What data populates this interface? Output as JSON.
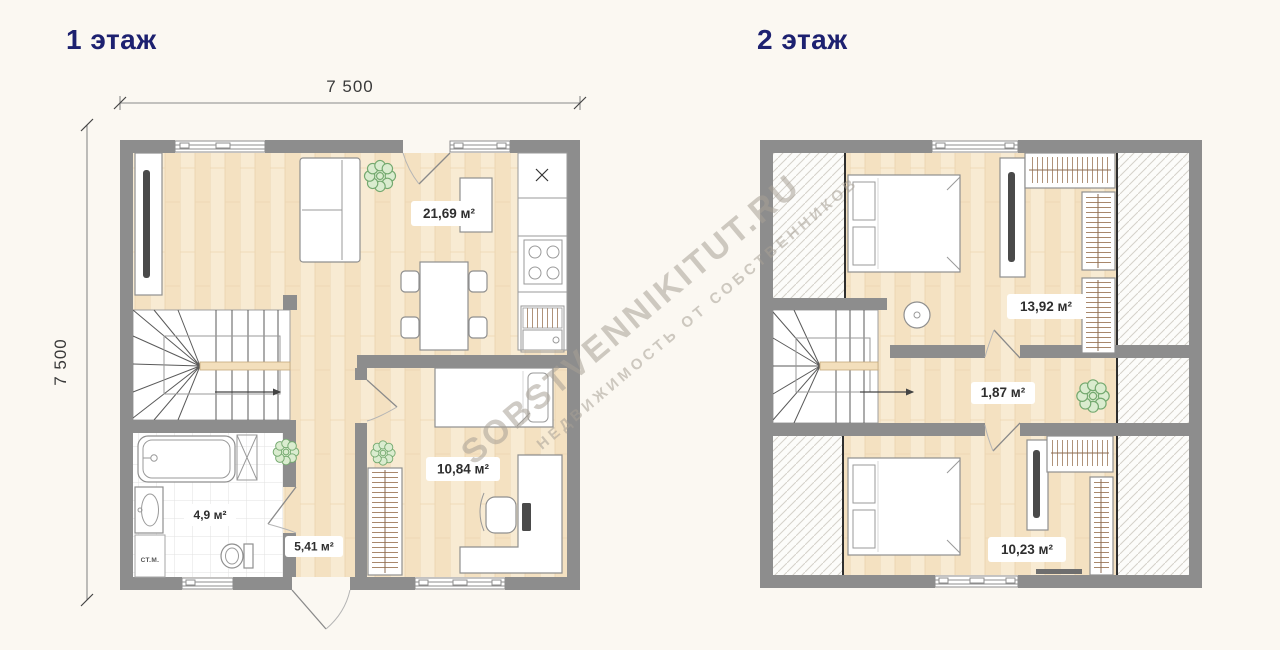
{
  "page": {
    "background": "#fbf8f2"
  },
  "watermark": {
    "line1": "SOBSTVENNIKITUT.RU",
    "line2": "НЕДВИЖИМОСТЬ ОТ СОБСТВЕННИКОВ"
  },
  "floors": [
    {
      "title": "1 этаж",
      "dimensions": {
        "top": "7 500",
        "left": "7 500"
      },
      "rooms": [
        {
          "name": "kitchen-living",
          "area": "21,69 м²"
        },
        {
          "name": "bedroom",
          "area": "10,84 м²"
        },
        {
          "name": "hallway",
          "area": "5,41 м²"
        },
        {
          "name": "bathroom",
          "area": "4,9 м²"
        }
      ],
      "appliance_labels": {
        "washing_machine": "СТ.М."
      }
    },
    {
      "title": "2 этаж",
      "rooms": [
        {
          "name": "bedroom-top",
          "area": "13,92 м²"
        },
        {
          "name": "hall",
          "area": "1,87 м²"
        },
        {
          "name": "bedroom-bottom",
          "area": "10,23 м²"
        }
      ]
    }
  ],
  "colors": {
    "title_navy": "#1d2170",
    "wall_gray": "#8d8d8d",
    "wood_floor": "#f6e6ca",
    "tile_line": "#e2e2e0",
    "hatch_line": "#d4d1ca",
    "watermark_gray": "#a7a096",
    "plant_green": "#74a96f",
    "label_text": "#2e2e2e"
  }
}
